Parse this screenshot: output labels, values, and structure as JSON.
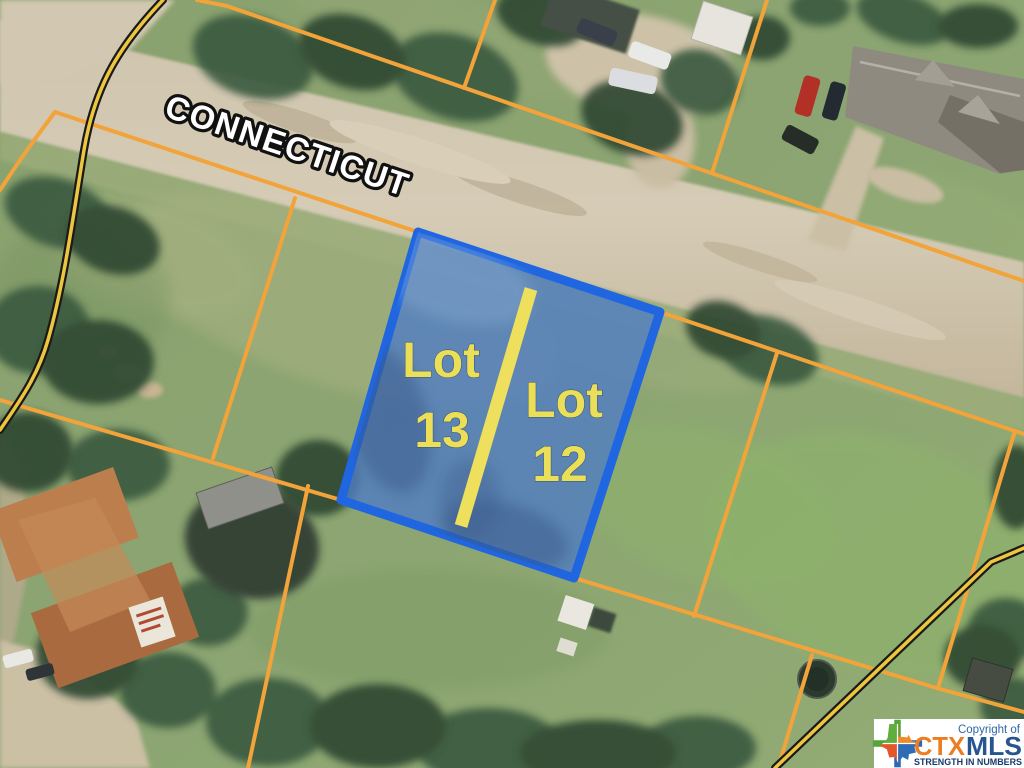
{
  "map": {
    "street_label": "CONNECTICUT",
    "parcels": [
      {
        "id": "lot-13",
        "line1": "Lot",
        "line2": "13"
      },
      {
        "id": "lot-12",
        "line1": "Lot",
        "line2": "12"
      }
    ],
    "highlight_border_color": "#1f66e0",
    "highlight_fill_color": "rgba(80,125,195,0.8)",
    "boundary_line_color": "#f2a33a",
    "road_edge_line_color": "#edc63e",
    "divider_color": "#eee05c",
    "label_color": "#ecdf58",
    "street_label_fill": "#ffffff",
    "street_label_outline": "#111111"
  },
  "logo": {
    "copyright": "Copyright of",
    "brand_ctx": "CTX",
    "brand_mls": "MLS",
    "tagline": "STRENGTH IN NUMBERS",
    "ctx_color": "#ed7d23",
    "mls_color": "#27568e",
    "tagline_color": "#173a68",
    "copyright_color": "#2f66a7",
    "texas_icon_colors": [
      "#5fae3e",
      "#ef8b2b",
      "#e2582b",
      "#2e6cb5"
    ]
  }
}
